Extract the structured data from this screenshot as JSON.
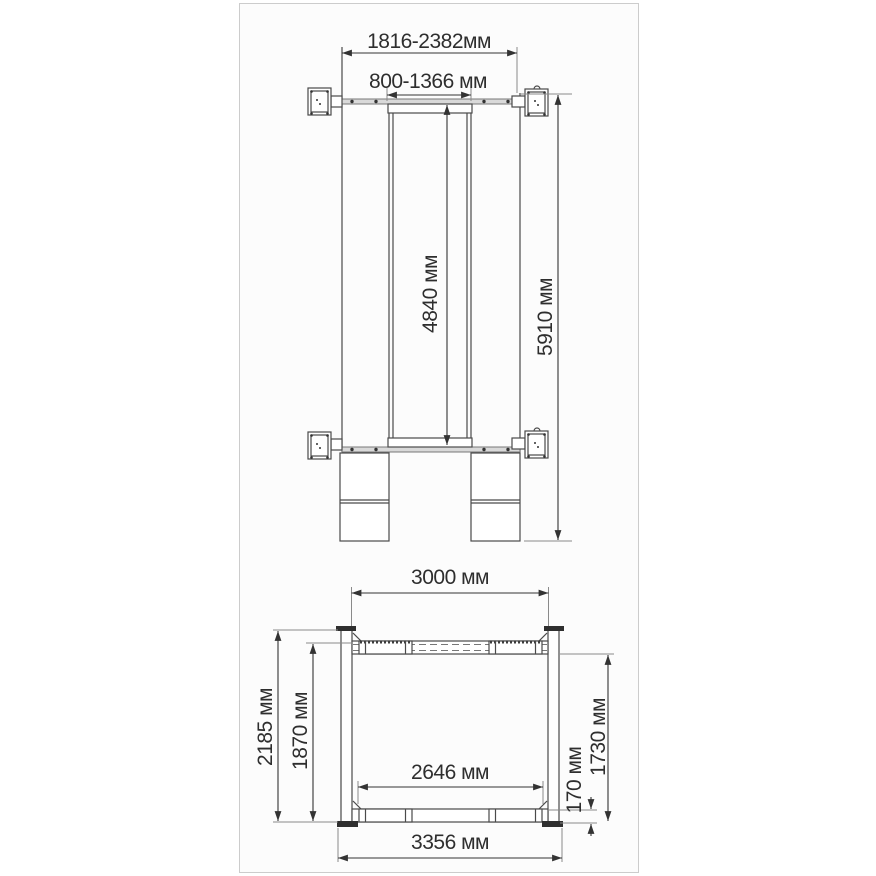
{
  "page": {
    "background": "#ffffff",
    "frame_border_color": "#cccccc",
    "line_color": "#4a4a4a",
    "dimension_color": "#333333",
    "unit": "мм"
  },
  "top_view": {
    "name": "plan view of lift",
    "dimensions": {
      "overall_width": "1816-2382мм",
      "carriage_width": "800-1366 мм",
      "platform_length": "4840 мм",
      "overall_length": "5910 мм"
    }
  },
  "front_view": {
    "name": "front view of lift",
    "dimensions": {
      "post_spacing": "3000 мм",
      "overall_height": "2185 мм",
      "lifting_height": "1870 мм",
      "inner_width": "2646 мм",
      "min_pad_height": "170 мм",
      "max_lift_height": "1730 мм",
      "overall_width": "3356 мм"
    }
  }
}
